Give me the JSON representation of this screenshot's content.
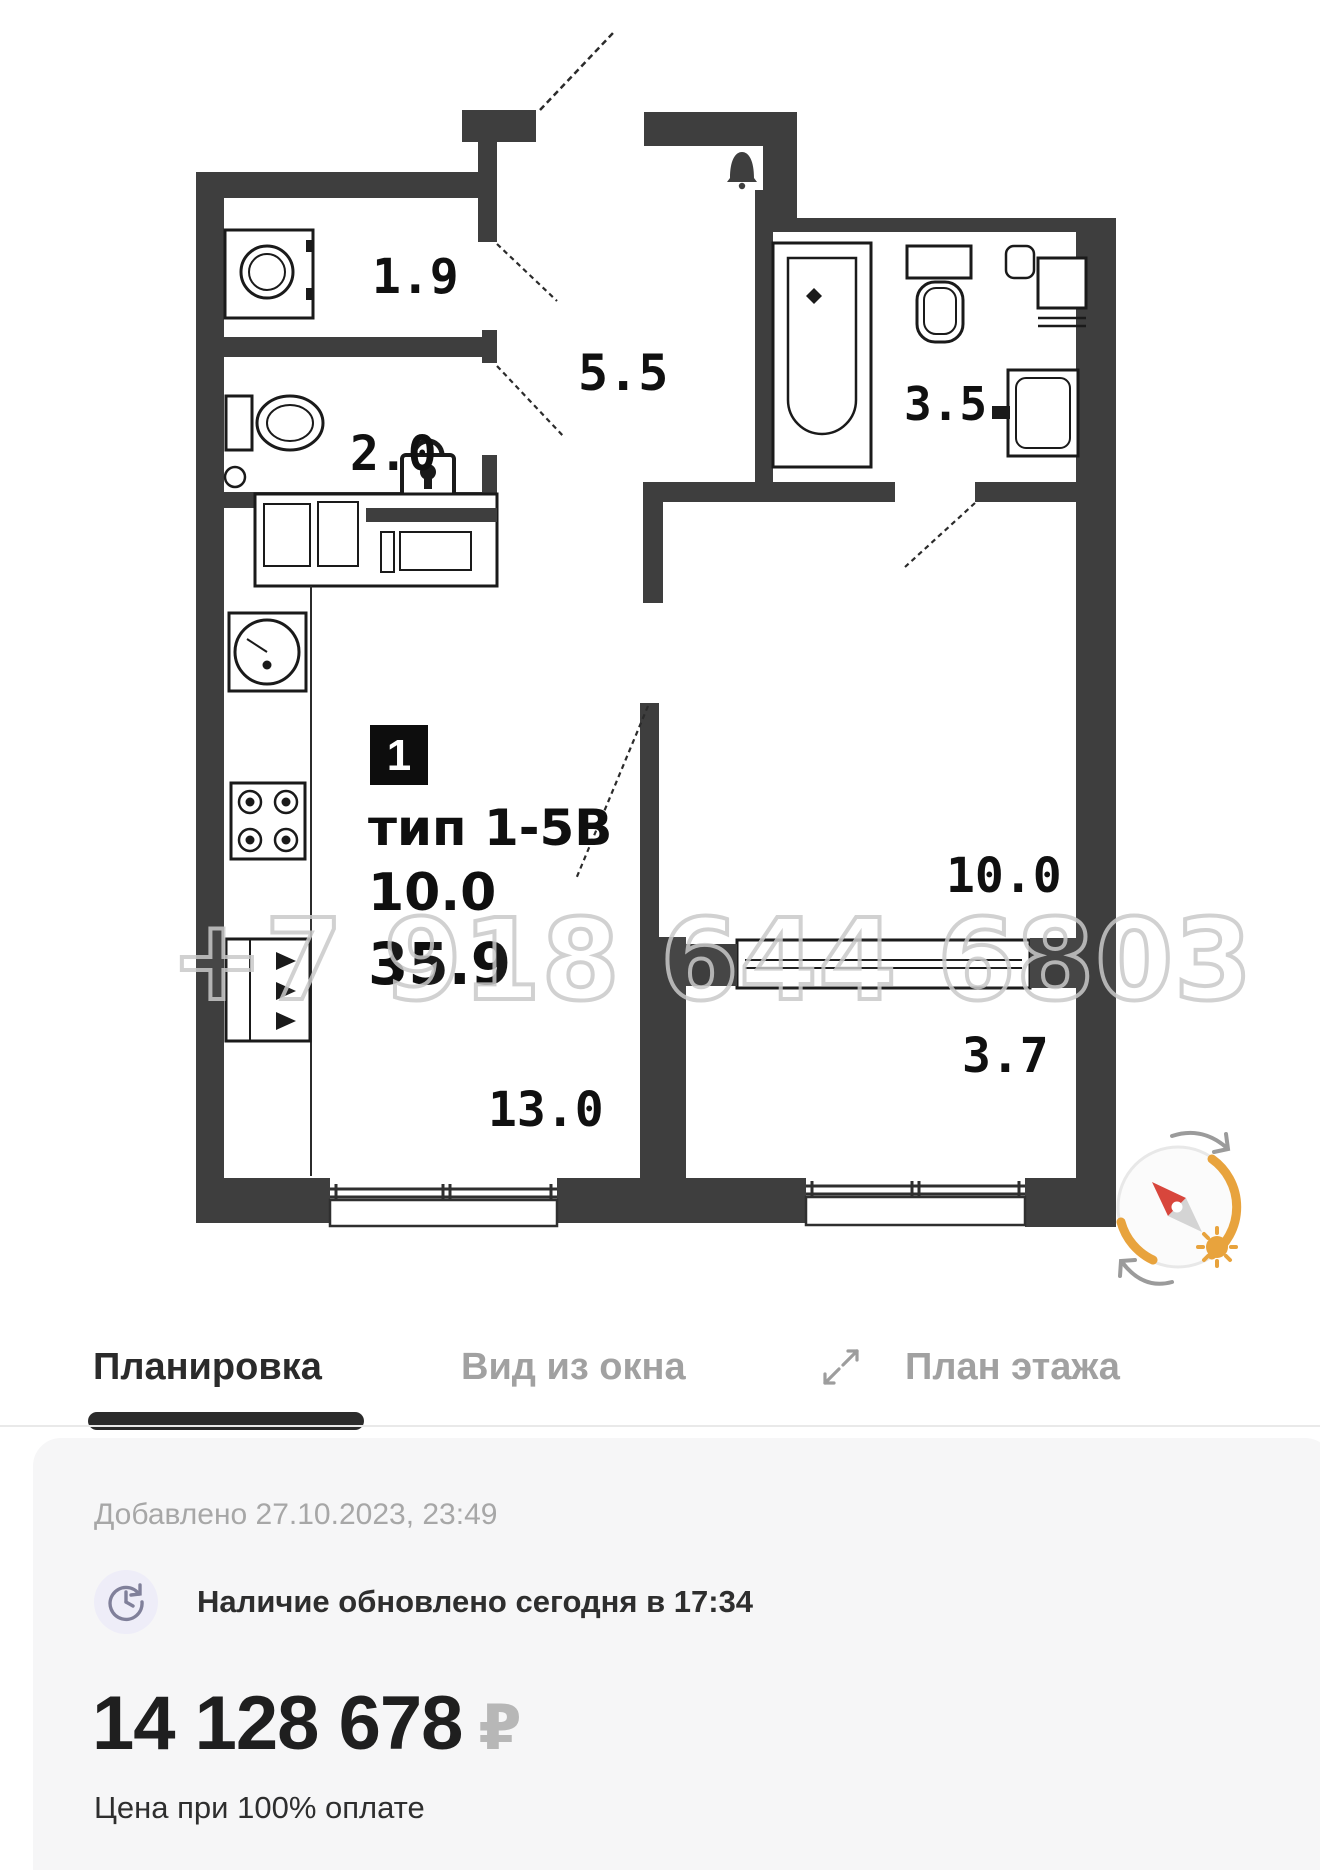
{
  "floor_plan": {
    "watermark": "+7 918 644 6803",
    "info": {
      "badge": "1",
      "type": "тип 1-5В",
      "living_area": "10.0",
      "total_area": "35.9"
    },
    "room_areas": {
      "storage": "1.9",
      "wc": "2.0",
      "hall": "5.5",
      "bathroom": "3.5",
      "kitchen_living": "13.0",
      "bedroom": "10.0",
      "loggia": "3.7"
    }
  },
  "tabs": [
    {
      "label": "Планировка",
      "active": true
    },
    {
      "label": "Вид из окна",
      "active": false
    },
    {
      "label": "План этажа",
      "active": false
    }
  ],
  "card": {
    "added": "Добавлено 27.10.2023, 23:49",
    "availability": "Наличие обновлено сегодня в 17:34",
    "price": "14 128 678",
    "currency": "₽",
    "price_note": "Цена при 100% оплате"
  },
  "colors": {
    "wall": "#3E3E3E",
    "accent_orange": "#E8A33D",
    "needle_red": "#D8463C",
    "tab_active": "#2B2B2B",
    "tab_inactive": "#A1A1A1",
    "card_bg": "#F6F6F7"
  }
}
